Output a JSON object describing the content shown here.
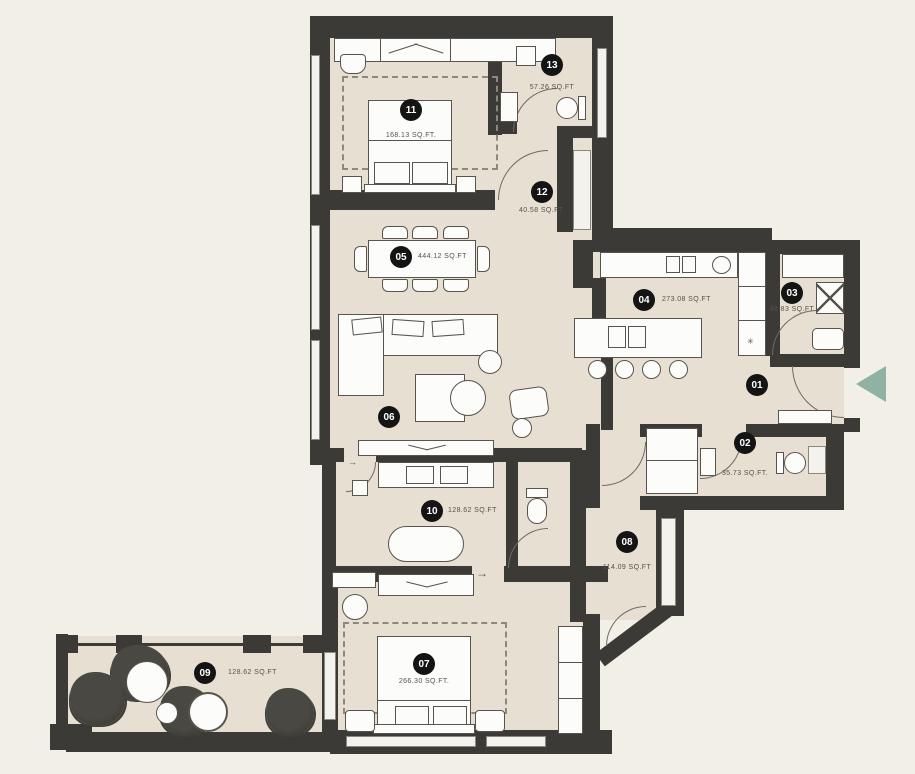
{
  "palette": {
    "background": "#f2efe7",
    "floor": "#e7dfd1",
    "wall": "#3b3a37",
    "fixture_fill": "#fcfcfa",
    "fixture_stroke": "#57544e",
    "marker_bg": "#141414",
    "marker_text": "#ffffff",
    "label_text": "#56524a",
    "entry_arrow": "#8fb2a5"
  },
  "rooms": [
    {
      "num": "01",
      "area": ""
    },
    {
      "num": "02",
      "area": "35.73 SQ.FT."
    },
    {
      "num": "03",
      "area": "48.83 SQ.FT"
    },
    {
      "num": "04",
      "area": "273.08 SQ.FT"
    },
    {
      "num": "05",
      "area": "444.12 SQ.FT"
    },
    {
      "num": "06",
      "area": ""
    },
    {
      "num": "07",
      "area": "266.30 SQ.FT."
    },
    {
      "num": "08",
      "area": "114.09 SQ.FT"
    },
    {
      "num": "09",
      "area": "128.62 SQ.FT"
    },
    {
      "num": "10",
      "area": "128.62 SQ.FT"
    },
    {
      "num": "11",
      "area": "168.13 SQ.FT."
    },
    {
      "num": "12",
      "area": "40.58 SQ.FT."
    },
    {
      "num": "13",
      "area": "57.26 SQ.FT"
    }
  ],
  "symbols": {
    "flow_arrow": "→",
    "appliance_star": "✳"
  }
}
